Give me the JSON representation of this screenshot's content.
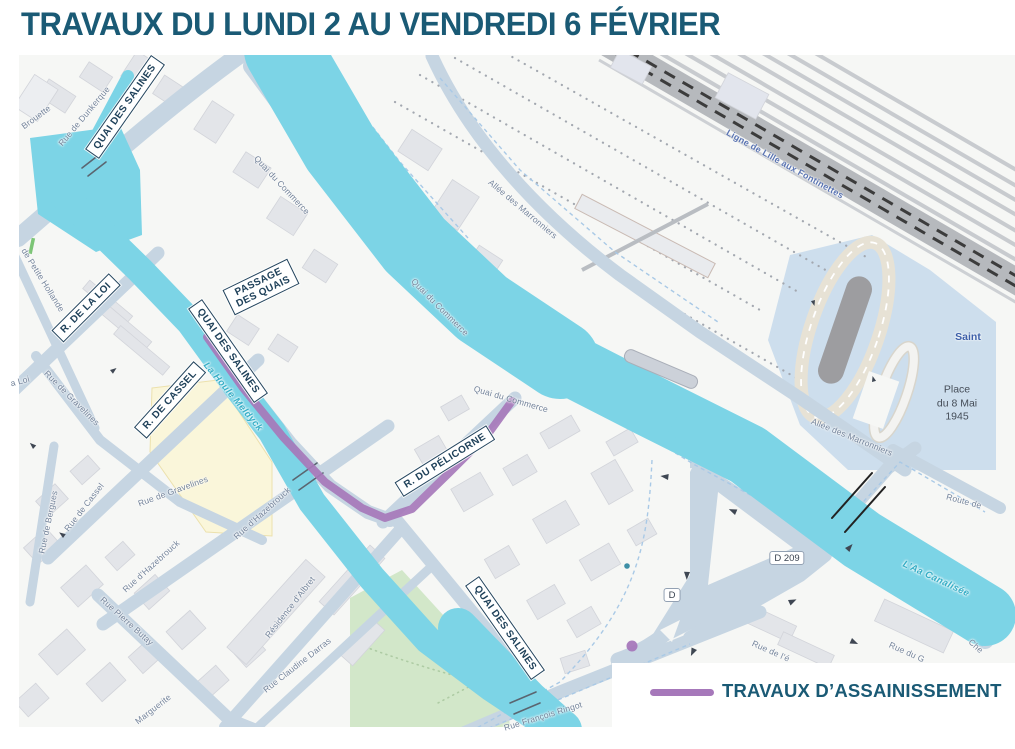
{
  "title": "TRAVAUX DU LUNDI 2 AU VENDREDI 6 FÉVRIER",
  "legend": {
    "swatch_color": "#A678BA",
    "label": "TRAVAUX D’ASSAINISSEMENT"
  },
  "map": {
    "works_color": "#A678BA",
    "boxed_street_labels": [
      {
        "text": "QUAI DES SALINES",
        "x": 125,
        "y": 107,
        "rot": -55
      },
      {
        "text": "R. DE LA LOI",
        "x": 86,
        "y": 308,
        "rot": -45
      },
      {
        "text": "R. DE CASSEL",
        "x": 170,
        "y": 400,
        "rot": -48
      },
      {
        "text": "QUAI DES SALINES",
        "x": 228,
        "y": 351,
        "rot": 55
      },
      {
        "text": "PASSAGE DES QUAIS",
        "x": 261,
        "y": 287,
        "rot": -26,
        "wrap": true
      },
      {
        "text": "R. DU PÉLICORNE",
        "x": 445,
        "y": 461,
        "rot": -32
      },
      {
        "text": "QUAI DES SALINES",
        "x": 505,
        "y": 628,
        "rot": 55
      }
    ],
    "street_labels": [
      {
        "text": "Brouette",
        "x": 36,
        "y": 117,
        "rot": -36
      },
      {
        "text": "Rue de Dunkerque",
        "x": 84,
        "y": 116,
        "rot": -50
      },
      {
        "text": "Quai du Commerce",
        "x": 282,
        "y": 185,
        "rot": 47
      },
      {
        "text": "Quai du Commerce",
        "x": 440,
        "y": 307,
        "rot": 45
      },
      {
        "text": "Quai du Commerce",
        "x": 511,
        "y": 399,
        "rot": 16
      },
      {
        "text": "de Petite Hollande",
        "x": 43,
        "y": 280,
        "rot": 58
      },
      {
        "text": "a Loi",
        "x": 20,
        "y": 381,
        "rot": -15
      },
      {
        "text": "Rue de Gravelines",
        "x": 72,
        "y": 398,
        "rot": 45
      },
      {
        "text": "Rue de Bergues",
        "x": 48,
        "y": 522,
        "rot": -78
      },
      {
        "text": "Rue de Cassel",
        "x": 84,
        "y": 507,
        "rot": -52
      },
      {
        "text": "Rue de Gravelines",
        "x": 173,
        "y": 491,
        "rot": -20
      },
      {
        "text": "Rue d’Hazebrouck",
        "x": 151,
        "y": 566,
        "rot": -42
      },
      {
        "text": "Rue d’Hazebrouck",
        "x": 262,
        "y": 513,
        "rot": -42
      },
      {
        "text": "Rue Pierre Butay",
        "x": 127,
        "y": 621,
        "rot": 42
      },
      {
        "text": "Marguerite",
        "x": 153,
        "y": 709,
        "rot": -38
      },
      {
        "text": "Résidence d’Albret",
        "x": 290,
        "y": 607,
        "rot": -52
      },
      {
        "text": "Rue Claudine Darras",
        "x": 297,
        "y": 665,
        "rot": -38
      },
      {
        "text": "Rue François Ringot",
        "x": 543,
        "y": 716,
        "rot": -17
      },
      {
        "text": "Rue de l’é",
        "x": 771,
        "y": 651,
        "rot": 24
      },
      {
        "text": "Rue du G",
        "x": 907,
        "y": 652,
        "rot": 24
      },
      {
        "text": "Che",
        "x": 976,
        "y": 646,
        "rot": 42
      },
      {
        "text": "Route de",
        "x": 964,
        "y": 501,
        "rot": 15
      },
      {
        "text": "Allée des Marronniers",
        "x": 523,
        "y": 209,
        "rot": 40
      },
      {
        "text": "Allée des Marronniers",
        "x": 852,
        "y": 437,
        "rot": 22
      }
    ],
    "water_labels": [
      {
        "text": "La Houle Meldyck",
        "x": 233,
        "y": 397,
        "rot": 50
      },
      {
        "text": "L’Aa Canalisée",
        "x": 936,
        "y": 579,
        "rot": 25
      }
    ],
    "railway_labels": [
      {
        "text": "Ligne de Lille aux Fontinettes",
        "x": 785,
        "y": 164,
        "rot": 29
      }
    ],
    "area_labels": [
      {
        "text": "Place\ndu 8 Mai\n1945",
        "x": 957,
        "y": 404,
        "style": "place"
      },
      {
        "text": "Saint",
        "x": 968,
        "y": 337,
        "style": "station"
      }
    ],
    "road_badges": [
      {
        "text": "D 209",
        "x": 787,
        "y": 558
      },
      {
        "text": "D",
        "x": 672,
        "y": 595
      }
    ]
  }
}
